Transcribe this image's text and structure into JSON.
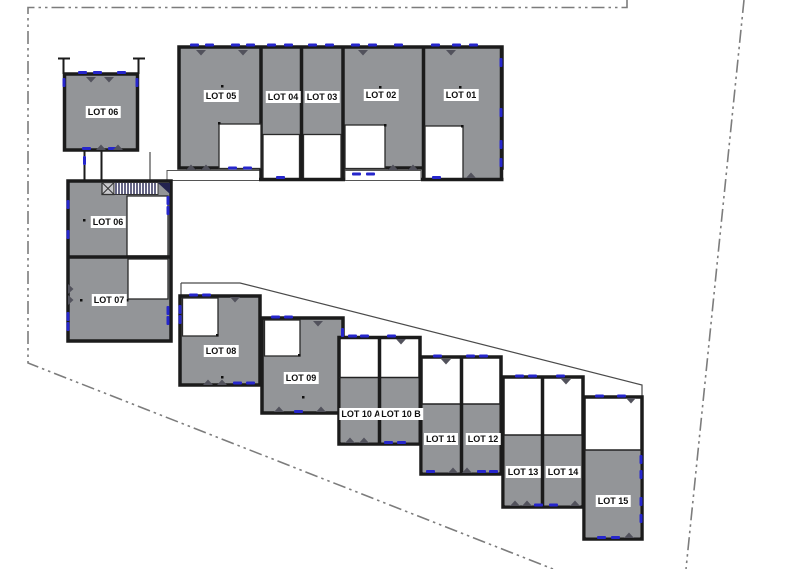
{
  "colors": {
    "background": "#ffffff",
    "building_fill": "#939598",
    "wall": "#1b1b1b",
    "courtyard_fill": "#ffffff",
    "window_marker_blue": "#2626cc",
    "door_marker_gray": "#52525c",
    "boundary_line_gray": "#7c7c7c",
    "stair_navy": "#23234f",
    "label_text": "#101010",
    "label_bg": "#ffffff"
  },
  "lots": [
    {
      "id": "lot-06-garage",
      "label": "LOT 06"
    },
    {
      "id": "lot-05",
      "label": "LOT 05"
    },
    {
      "id": "lot-04",
      "label": "LOT 04"
    },
    {
      "id": "lot-03",
      "label": "LOT 03"
    },
    {
      "id": "lot-02",
      "label": "LOT 02"
    },
    {
      "id": "lot-01",
      "label": "LOT 01"
    },
    {
      "id": "lot-06",
      "label": "LOT 06"
    },
    {
      "id": "lot-07",
      "label": "LOT 07"
    },
    {
      "id": "lot-08",
      "label": "LOT 08"
    },
    {
      "id": "lot-09",
      "label": "LOT 09"
    },
    {
      "id": "lot-10a",
      "label": "LOT 10 A"
    },
    {
      "id": "lot-10b",
      "label": "LOT 10 B"
    },
    {
      "id": "lot-11",
      "label": "LOT 11"
    },
    {
      "id": "lot-12",
      "label": "LOT 12"
    },
    {
      "id": "lot-13",
      "label": "LOT 13"
    },
    {
      "id": "lot-14",
      "label": "LOT 14"
    },
    {
      "id": "lot-15",
      "label": "LOT 15"
    }
  ]
}
